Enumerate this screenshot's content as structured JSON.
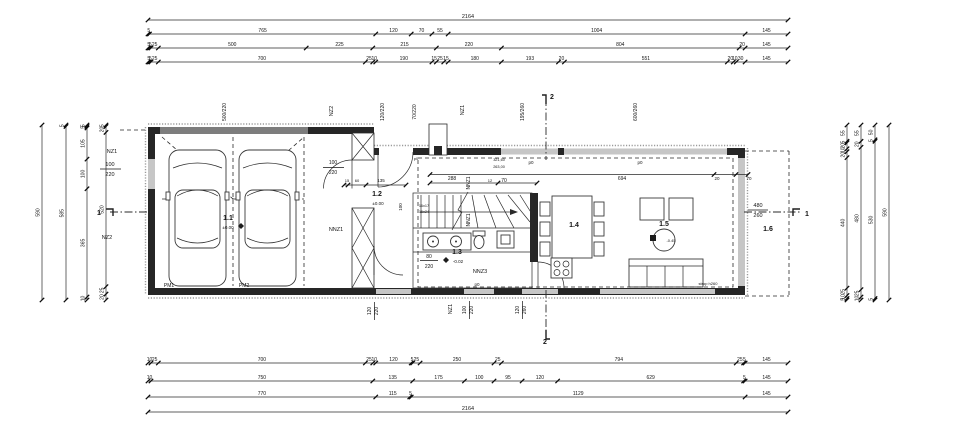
{
  "colors": {
    "ink": "#1f1f1f",
    "wall": "#262626",
    "door_band": "#7d7d7d",
    "window_band": "#c6c6c6"
  },
  "texts": [
    {
      "t": "500/220",
      "x": 226,
      "y": 112,
      "r": 1,
      "s": 5,
      "n": "garage-door-size-label"
    },
    {
      "t": "NZ2",
      "x": 333,
      "y": 111,
      "r": 1,
      "s": 5.5,
      "n": "wall-tag-nz2-top"
    },
    {
      "t": "120/220",
      "x": 384,
      "y": 112,
      "r": 1,
      "s": 5,
      "n": "entry-door-size-label"
    },
    {
      "t": "70/220",
      "x": 416,
      "y": 112,
      "r": 1,
      "s": 5,
      "n": "opening-size-label"
    },
    {
      "t": "NZ1",
      "x": 464,
      "y": 110,
      "r": 1,
      "s": 5.5,
      "n": "wall-tag-nz1-top"
    },
    {
      "t": "195/260",
      "x": 524,
      "y": 112,
      "r": 1,
      "s": 5,
      "n": "window-size-195-260"
    },
    {
      "t": "600/260",
      "x": 637,
      "y": 112,
      "r": 1,
      "s": 5,
      "n": "window-size-600-260"
    },
    {
      "t": "2",
      "x": 552,
      "y": 99,
      "s": 7,
      "b": 1,
      "n": "section-marker-2-top"
    },
    {
      "t": "NZ1",
      "x": 112,
      "y": 153,
      "s": 5.5,
      "n": "wall-tag-nz1-left"
    },
    {
      "t": "100",
      "x": 110,
      "y": 166,
      "s": 5.5,
      "n": "window-width-left"
    },
    {
      "t": "220",
      "x": 110,
      "y": 176,
      "s": 5.5,
      "n": "window-height-left"
    },
    {
      "t": "NZ2",
      "x": 107,
      "y": 239,
      "s": 5.5,
      "n": "wall-tag-nz2-left"
    },
    {
      "t": "1",
      "x": 99,
      "y": 215,
      "s": 7,
      "b": 1,
      "n": "section-marker-1-left"
    },
    {
      "t": "1.1",
      "x": 228,
      "y": 220,
      "s": 7,
      "b": 1,
      "n": "room-label-1-1-garage"
    },
    {
      "t": "±0.00",
      "x": 228,
      "y": 229,
      "s": 4.5,
      "n": "level-garage"
    },
    {
      "t": "PM1",
      "x": 169,
      "y": 287,
      "s": 5,
      "n": "parking-spot-1"
    },
    {
      "t": "PM2",
      "x": 244,
      "y": 287,
      "s": 5,
      "n": "parking-spot-2"
    },
    {
      "t": "NNZ1",
      "x": 336,
      "y": 231,
      "s": 5.5,
      "n": "wall-tag-nnz1"
    },
    {
      "t": "100",
      "x": 333,
      "y": 164,
      "s": 5,
      "n": "door-width-garage"
    },
    {
      "t": "220",
      "x": 333,
      "y": 174,
      "s": 5,
      "n": "door-height-garage"
    },
    {
      "t": "15",
      "x": 347,
      "y": 182,
      "s": 4,
      "n": "dim-15"
    },
    {
      "t": "60",
      "x": 357,
      "y": 182,
      "s": 4,
      "n": "dim-60"
    },
    {
      "t": "135",
      "x": 381,
      "y": 182,
      "s": 4.5,
      "n": "dim-135"
    },
    {
      "t": "1.2",
      "x": 377,
      "y": 196,
      "s": 7,
      "b": 1,
      "n": "room-label-1-2-entry"
    },
    {
      "t": "±0.00",
      "x": 378,
      "y": 205,
      "s": 4.5,
      "n": "level-entry"
    },
    {
      "t": "p0",
      "x": 416,
      "y": 160,
      "s": 4,
      "n": "p0-tag-porch"
    },
    {
      "t": "288",
      "x": 452,
      "y": 180,
      "s": 5,
      "n": "dim-288"
    },
    {
      "t": "12",
      "x": 490,
      "y": 182,
      "s": 4,
      "n": "dim-12"
    },
    {
      "t": "70",
      "x": 504,
      "y": 182,
      "s": 5,
      "n": "dim-70"
    },
    {
      "t": "NNZ1",
      "x": 470,
      "y": 183,
      "r": 1,
      "s": 5,
      "n": "wall-tag-nnz1-stair-a"
    },
    {
      "t": "NNZ1",
      "x": 470,
      "y": 220,
      "r": 1,
      "s": 5,
      "n": "wall-tag-nnz1-stair-b"
    },
    {
      "t": "100",
      "x": 402,
      "y": 207,
      "r": 1,
      "s": 4.5,
      "n": "dim-100-stair"
    },
    {
      "t": "16x17",
      "x": 424,
      "y": 207,
      "s": 3.8,
      "n": "stair-riser-note"
    },
    {
      "t": "16x24",
      "x": 424,
      "y": 213,
      "s": 3.8,
      "n": "stair-tread-note"
    },
    {
      "t": "321,60",
      "x": 499,
      "y": 161,
      "s": 3.8,
      "n": "note-321-60"
    },
    {
      "t": "263,00",
      "x": 499,
      "y": 168,
      "s": 3.8,
      "n": "note-263-00"
    },
    {
      "t": "1.3",
      "x": 457,
      "y": 254,
      "s": 7,
      "b": 1,
      "n": "room-label-1-3-bath"
    },
    {
      "t": "-0.02",
      "x": 458,
      "y": 263,
      "s": 4.5,
      "n": "level-bath"
    },
    {
      "t": "80",
      "x": 429,
      "y": 258,
      "s": 5,
      "n": "door-width-bath"
    },
    {
      "t": "220",
      "x": 429,
      "y": 268,
      "s": 5,
      "n": "door-height-bath"
    },
    {
      "t": "NNZ3",
      "x": 480,
      "y": 273,
      "s": 5.5,
      "n": "wall-tag-nnz3"
    },
    {
      "t": "p0",
      "x": 477,
      "y": 286,
      "s": 4.5,
      "n": "p0-tag-nnz3"
    },
    {
      "t": "p0",
      "x": 531,
      "y": 164,
      "s": 4.5,
      "n": "p0-tag-living-a"
    },
    {
      "t": "p0",
      "x": 640,
      "y": 164,
      "s": 4.5,
      "n": "p0-tag-living-b"
    },
    {
      "t": "694",
      "x": 622,
      "y": 180,
      "s": 5,
      "n": "dim-694"
    },
    {
      "t": "20",
      "x": 717,
      "y": 180,
      "s": 4.5,
      "n": "dim-20"
    },
    {
      "t": "70",
      "x": 749,
      "y": 180,
      "s": 4.5,
      "n": "dim-70-right"
    },
    {
      "t": "1.4",
      "x": 574,
      "y": 227,
      "s": 7,
      "b": 1,
      "n": "room-label-1-4-dining"
    },
    {
      "t": "1.5",
      "x": 664,
      "y": 226,
      "s": 7,
      "b": 1,
      "n": "room-label-1-5-living"
    },
    {
      "t": "-0.45",
      "x": 671,
      "y": 242,
      "s": 4,
      "n": "level-living"
    },
    {
      "t": "1.6",
      "x": 768,
      "y": 231,
      "s": 7,
      "b": 1,
      "n": "room-label-1-6-terrace"
    },
    {
      "t": "480",
      "x": 758,
      "y": 207,
      "s": 5.5,
      "n": "window-width-right"
    },
    {
      "t": "260",
      "x": 758,
      "y": 217,
      "s": 5.5,
      "n": "window-height-right"
    },
    {
      "t": "strop h260",
      "x": 708,
      "y": 285,
      "s": 4,
      "n": "ceiling-note"
    },
    {
      "t": "1",
      "x": 807,
      "y": 216,
      "s": 7,
      "b": 1,
      "n": "section-marker-1-right"
    },
    {
      "t": "120",
      "x": 371,
      "y": 311,
      "r": 1,
      "s": 5,
      "n": "window-width-bottom-a"
    },
    {
      "t": "220",
      "x": 378,
      "y": 311,
      "r": 1,
      "s": 5,
      "n": "window-height-bottom-a"
    },
    {
      "t": "NZ1",
      "x": 452,
      "y": 309,
      "r": 1,
      "s": 5.5,
      "n": "wall-tag-nz1-bottom"
    },
    {
      "t": "100",
      "x": 466,
      "y": 310,
      "r": 1,
      "s": 5,
      "n": "door-width-bottom"
    },
    {
      "t": "220",
      "x": 473,
      "y": 310,
      "r": 1,
      "s": 5,
      "n": "door-height-bottom"
    },
    {
      "t": "120",
      "x": 519,
      "y": 310,
      "r": 1,
      "s": 5,
      "n": "window-width-bottom-b"
    },
    {
      "t": "260",
      "x": 526,
      "y": 310,
      "r": 1,
      "s": 5,
      "n": "window-height-bottom-b"
    },
    {
      "t": "2",
      "x": 545,
      "y": 344,
      "s": 7,
      "b": 1,
      "n": "section-marker-2-bottom"
    }
  ],
  "dim_chains": [
    {
      "o": "h",
      "x1": 148,
      "x2": 788,
      "y": 20,
      "fs": 5.5,
      "segs": [
        {
          "w": 2164,
          "t": "2164"
        }
      ]
    },
    {
      "o": "h",
      "x1": 148,
      "x2": 788,
      "y": 34,
      "segs": [
        {
          "w": 5,
          "t": "5"
        },
        {
          "w": 765,
          "t": "765"
        },
        {
          "w": 120,
          "t": "120"
        },
        {
          "w": 70,
          "t": "70"
        },
        {
          "w": 55,
          "t": "55"
        },
        {
          "w": 1004,
          "t": "1004"
        },
        {
          "w": 145,
          "t": "145"
        }
      ]
    },
    {
      "o": "h",
      "x1": 148,
      "x2": 788,
      "y": 48,
      "segs": [
        {
          "w": 5,
          "t": "5"
        },
        {
          "w": 5,
          "t": "5"
        },
        {
          "w": 25,
          "t": "25"
        },
        {
          "w": 500,
          "t": "500"
        },
        {
          "w": 225,
          "t": "225"
        },
        {
          "w": 215,
          "t": "215"
        },
        {
          "w": 220,
          "t": "220"
        },
        {
          "w": 804,
          "t": "804"
        },
        {
          "w": 20,
          "t": "20"
        },
        {
          "w": 145,
          "t": "145"
        }
      ]
    },
    {
      "o": "h",
      "x1": 148,
      "x2": 788,
      "y": 62,
      "segs": [
        {
          "w": 5,
          "t": "5"
        },
        {
          "w": 5,
          "t": "5"
        },
        {
          "w": 25,
          "t": "25"
        },
        {
          "w": 700,
          "t": "700"
        },
        {
          "w": 25,
          "t": "25"
        },
        {
          "w": 10,
          "t": "10"
        },
        {
          "w": 190,
          "t": "190"
        },
        {
          "w": 15,
          "t": "15"
        },
        {
          "w": 25,
          "t": "25"
        },
        {
          "w": 15,
          "t": "15"
        },
        {
          "w": 180,
          "t": "180"
        },
        {
          "w": 193,
          "t": "193"
        },
        {
          "w": 20,
          "t": "20"
        },
        {
          "w": 551,
          "t": "551"
        },
        {
          "w": 20,
          "t": "20"
        },
        {
          "w": 10,
          "t": "10"
        },
        {
          "w": 30,
          "t": "30"
        },
        {
          "w": 145,
          "t": "145"
        }
      ]
    },
    {
      "o": "h",
      "x1": 148,
      "x2": 788,
      "y": 363,
      "segs": [
        {
          "w": 10,
          "t": "10"
        },
        {
          "w": 25,
          "t": "25"
        },
        {
          "w": 700,
          "t": "700"
        },
        {
          "w": 25,
          "t": "25"
        },
        {
          "w": 10,
          "t": "10"
        },
        {
          "w": 120,
          "t": "120"
        },
        {
          "w": 5,
          "t": "5"
        },
        {
          "w": 25,
          "t": "25"
        },
        {
          "w": 250,
          "t": "250"
        },
        {
          "w": 25,
          "t": "25"
        },
        {
          "w": 794,
          "t": "794"
        },
        {
          "w": 25,
          "t": "25"
        },
        {
          "w": 5,
          "t": "5"
        },
        {
          "w": 145,
          "t": "145"
        }
      ]
    },
    {
      "o": "h",
      "x1": 148,
      "x2": 788,
      "y": 381,
      "segs": [
        {
          "w": 10,
          "t": "10"
        },
        {
          "w": 750,
          "t": "750"
        },
        {
          "w": 135,
          "t": "135"
        },
        {
          "w": 175,
          "t": "175"
        },
        {
          "w": 100,
          "t": "100"
        },
        {
          "w": 95,
          "t": "95"
        },
        {
          "w": 120,
          "t": "120"
        },
        {
          "w": 629,
          "t": "629"
        },
        {
          "w": 5,
          "t": "5"
        },
        {
          "w": 145,
          "t": "145"
        }
      ]
    },
    {
      "o": "h",
      "x1": 148,
      "x2": 788,
      "y": 397,
      "segs": [
        {
          "w": 770,
          "t": "770"
        },
        {
          "w": 115,
          "t": "115"
        },
        {
          "w": 5,
          "t": "5"
        },
        {
          "w": 1129,
          "t": "1129"
        },
        {
          "w": 145,
          "t": "145"
        }
      ]
    },
    {
      "o": "h",
      "x1": 148,
      "x2": 788,
      "y": 412,
      "fs": 5.5,
      "segs": [
        {
          "w": 2164,
          "t": "2164"
        }
      ]
    },
    {
      "o": "v",
      "x": 42,
      "y1": 125,
      "y2": 300,
      "segs": [
        {
          "w": 590,
          "t": "590"
        }
      ]
    },
    {
      "o": "v",
      "x": 66,
      "y1": 125,
      "y2": 300,
      "segs": [
        {
          "w": 5,
          "t": "5"
        },
        {
          "w": 585,
          "t": "585"
        }
      ]
    },
    {
      "o": "v",
      "x": 87,
      "y1": 125,
      "y2": 300,
      "segs": [
        {
          "w": 5,
          "t": "5"
        },
        {
          "w": 5,
          "t": "5"
        },
        {
          "w": 105,
          "t": "105"
        },
        {
          "w": 100,
          "t": "100"
        },
        {
          "w": 365,
          "t": "365"
        },
        {
          "w": 10,
          "t": "10"
        }
      ]
    },
    {
      "o": "v",
      "x": 106,
      "y1": 125,
      "y2": 300,
      "segs": [
        {
          "w": 5,
          "t": "5"
        },
        {
          "w": 20,
          "t": "20"
        },
        {
          "w": 520,
          "t": "520"
        },
        {
          "w": 25,
          "t": "25"
        },
        {
          "w": 20,
          "t": "20"
        }
      ]
    },
    {
      "o": "v",
      "x": 847,
      "y1": 125,
      "y2": 300,
      "segs": [
        {
          "w": 55,
          "t": "55"
        },
        {
          "w": 5,
          "t": "5"
        },
        {
          "w": 20,
          "t": "20"
        },
        {
          "w": 10,
          "t": "10"
        },
        {
          "w": 20,
          "t": "20"
        },
        {
          "w": 440,
          "t": "440"
        },
        {
          "w": 25,
          "t": "25"
        },
        {
          "w": 10,
          "t": "10"
        },
        {
          "w": 5,
          "t": "5"
        }
      ]
    },
    {
      "o": "v",
      "x": 861,
      "y1": 125,
      "y2": 300,
      "segs": [
        {
          "w": 55,
          "t": "55"
        },
        {
          "w": 20,
          "t": "20"
        },
        {
          "w": 480,
          "t": "480"
        },
        {
          "w": 25,
          "t": "25"
        },
        {
          "w": 10,
          "t": "10"
        }
      ]
    },
    {
      "o": "v",
      "x": 875,
      "y1": 125,
      "y2": 300,
      "segs": [
        {
          "w": 50,
          "t": "50"
        },
        {
          "w": 5,
          "t": "5"
        },
        {
          "w": 530,
          "t": "530"
        },
        {
          "w": 5,
          "t": "5"
        }
      ]
    },
    {
      "o": "v",
      "x": 889,
      "y1": 125,
      "y2": 300,
      "segs": [
        {
          "w": 590,
          "t": "590"
        }
      ]
    }
  ]
}
